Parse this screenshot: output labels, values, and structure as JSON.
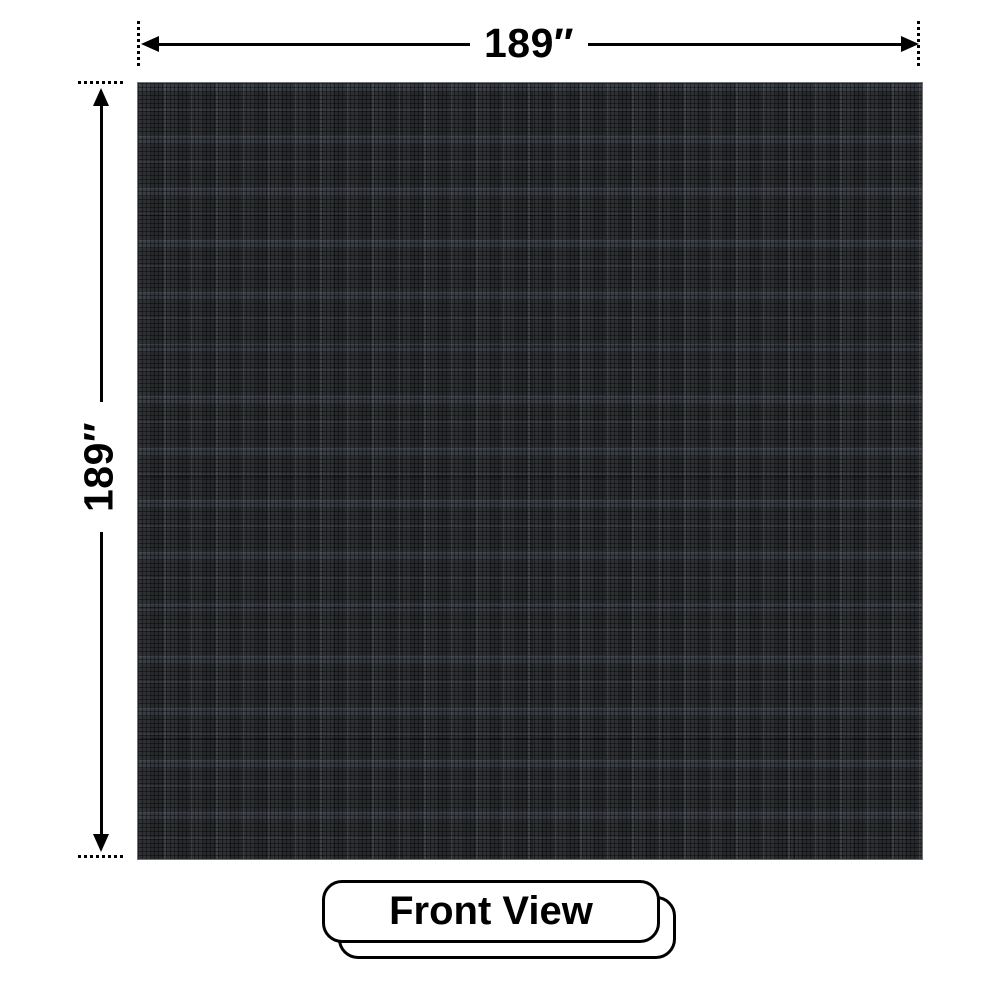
{
  "canvas": {
    "background_color": "#ffffff"
  },
  "panel": {
    "description": "dark LED screen front face with fine pixel-grid plaid texture",
    "base_color": "#26282c"
  },
  "dimensions": {
    "width": {
      "label": "189″",
      "value": 189,
      "unit": "inches"
    },
    "height": {
      "label": "189″",
      "value": 189,
      "unit": "inches"
    }
  },
  "view_tag": {
    "label": "Front View"
  },
  "icons": {
    "left_arrowhead": "solid black triangle pointing left",
    "right_arrowhead": "solid black triangle pointing right",
    "up_arrowhead": "solid black triangle pointing up",
    "down_arrowhead": "solid black triangle pointing down"
  },
  "colors": {
    "line": "#000000",
    "panel_base": "#26282c",
    "background": "#ffffff"
  }
}
